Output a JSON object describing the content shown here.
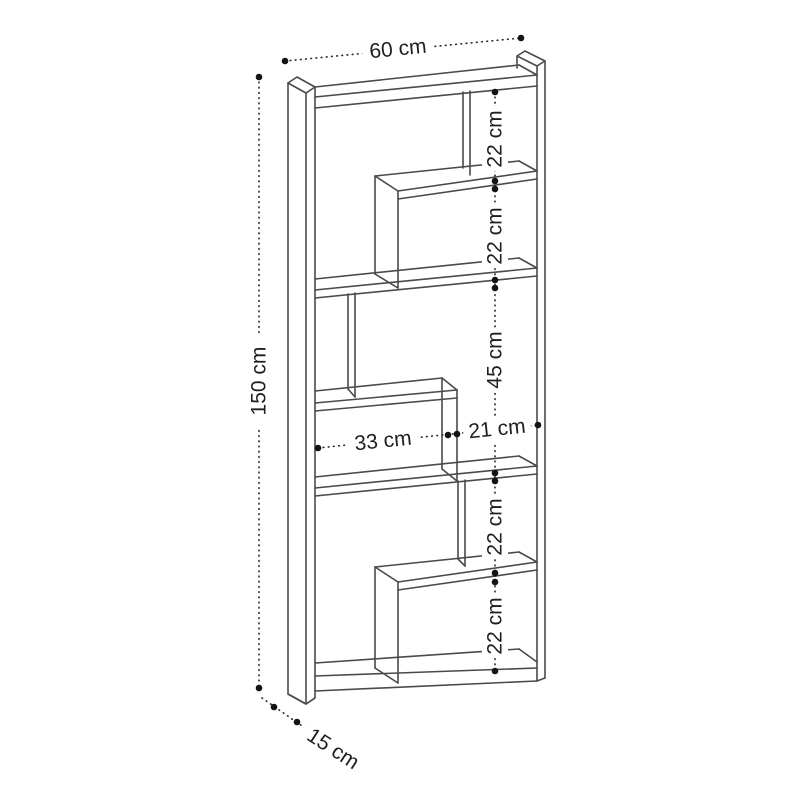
{
  "diagram": {
    "kind": "bookcase-dimension-drawing",
    "labels": {
      "width": "60 cm",
      "height": "150 cm",
      "depth": "15 cm",
      "sec1": "22 cm",
      "sec2": "22 cm",
      "sec3": "45 cm",
      "sec4": "22 cm",
      "sec5": "22 cm",
      "inner_left_width": "33 cm",
      "inner_right_width": "21 cm"
    },
    "colors": {
      "line": "#4a4a4a",
      "dimension": "#2f2f2f",
      "text": "#1f1f1f",
      "background": "#ffffff"
    }
  }
}
